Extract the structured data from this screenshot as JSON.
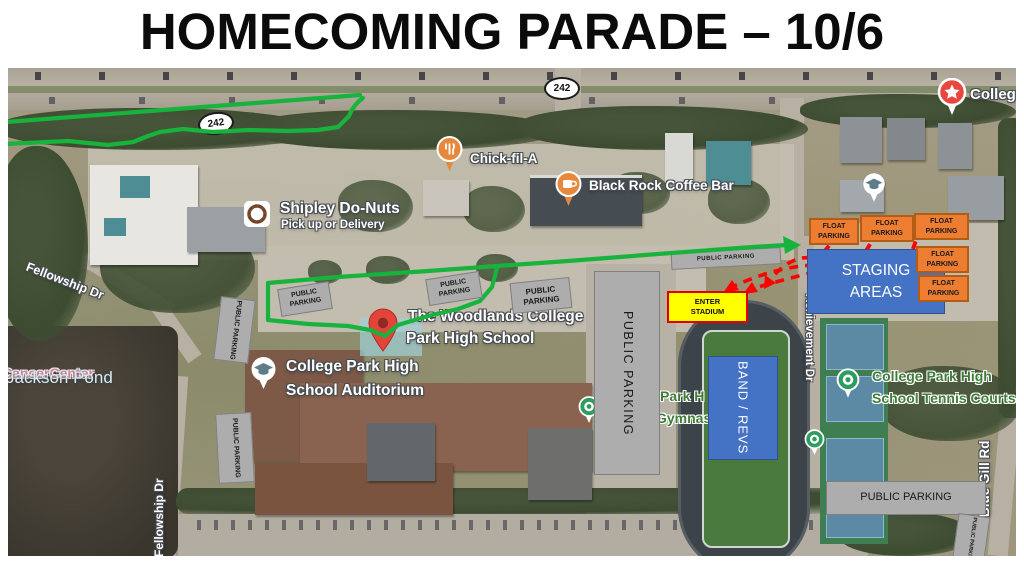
{
  "title": "HOMECOMING PARADE – 10/6",
  "roads": {
    "route_shield": "242",
    "fellowship_dr": "Fellowship Dr",
    "achievement_dr": "Achievement Dr",
    "blue_gill_rd": "Blue Gill Rd"
  },
  "places": {
    "cancer_center": "CancerCenter",
    "jackson_pond": "Jackson Pond",
    "chick_fil_a": "Chick-fil-A",
    "black_rock_coffee": "Black Rock Coffee Bar",
    "shipley": "Shipley Do-Nuts",
    "shipley_sub": "Pick up or Delivery",
    "school_l1": "The Woodlands College",
    "school_l2": "Park High School",
    "auditorium_l1": "College Park High",
    "auditorium_l2": "School Auditorium",
    "tennis_l1": "College Park High",
    "tennis_l2": "School Tennis Courts",
    "gym_l1": "Park H",
    "gym_l2": "Gymnas",
    "college_clipped": "Colleg"
  },
  "overlays": {
    "float_parking": "FLOAT PARKING",
    "public_parking": "PUBLIC PARKING",
    "staging_areas": "STAGING AREAS",
    "enter_stadium": "ENTER STADIUM",
    "band_revs": "BAND / REVS"
  },
  "colors": {
    "route_green": "#17b33c",
    "arrow_red": "#ff0000",
    "box_blue": "#4472c4",
    "box_orange": "#ed7d31",
    "box_gray": "#adadad",
    "box_yellow": "#ffff00"
  }
}
